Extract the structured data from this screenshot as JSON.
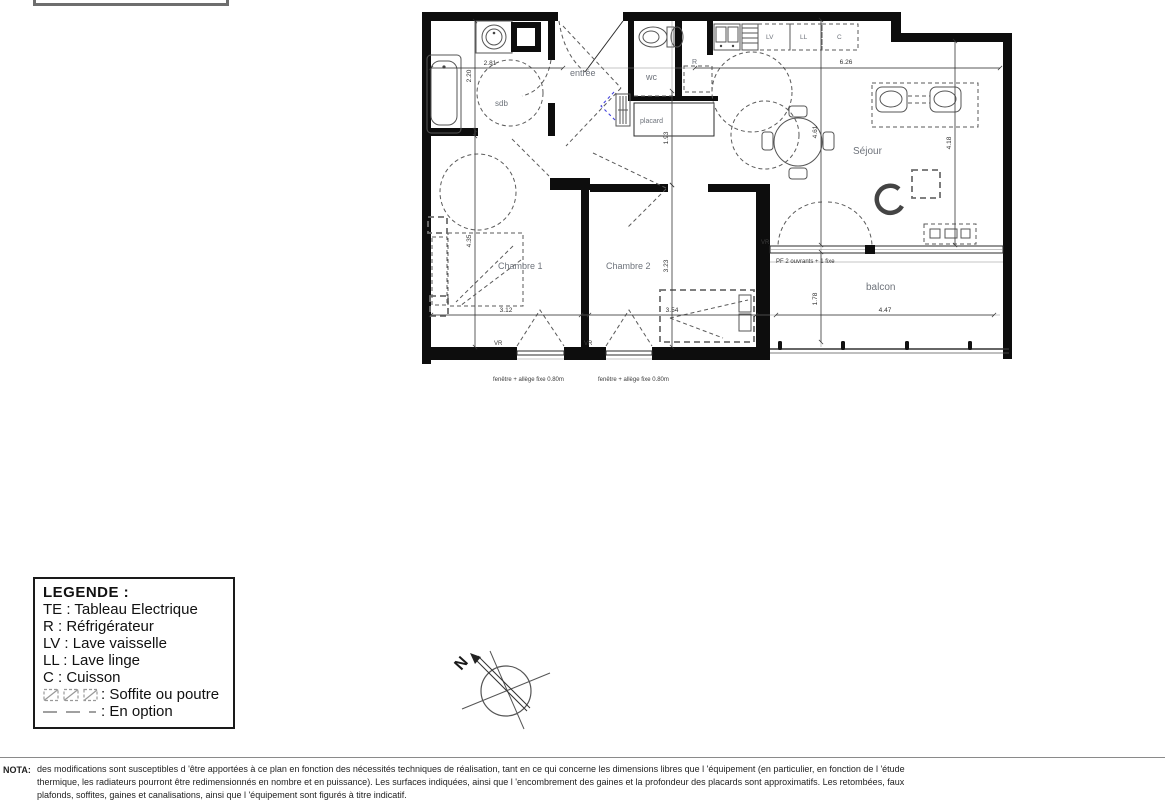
{
  "plan": {
    "room_labels": {
      "sdb": "sdb",
      "entree": "entrée",
      "wc": "wc",
      "placard": "placard",
      "sejour": "Séjour",
      "chambre1": "Chambre 1",
      "chambre2": "Chambre 2",
      "balcon": "balcon"
    },
    "appliance_labels": {
      "lv": "LV",
      "ll": "LL",
      "c": "C",
      "r": "R"
    },
    "annotations": {
      "vr": "VR",
      "pf": "PF 2 ouvrants + 1 fixe",
      "window_note": "fenêtre + allège fixe 0.80m",
      "north": "N"
    },
    "dimensions": {
      "sdb_w": "2.81",
      "sdb_h": "2.20",
      "sejour_w": "6.26",
      "hall_h": "1.93",
      "chambre2_h": "3.23",
      "sejour_h": "4.18",
      "sejour_mid_h": "4.61",
      "chambre1_h": "4.35",
      "chambre1_w": "3.12",
      "chambre2_w": "3.54",
      "balcon_w": "4.47",
      "balcon_h": "1.78"
    }
  },
  "legend": {
    "title": "LEGENDE :",
    "items": [
      "TE : Tableau Electrique",
      "R : Réfrigérateur",
      "LV : Lave vaisselle",
      "LL : Lave linge",
      "C : Cuisson"
    ],
    "soffite_label": ": Soffite ou poutre",
    "option_label": ": En option"
  },
  "nota": {
    "label": "NOTA:",
    "line1": "des modifications sont susceptibles d 'être apportées à ce plan en fonction des nécessités techniques de réalisation, tant en ce qui concerne les dimensions libres que l 'équipement (en particulier, en fonction de l 'étude",
    "line2": "thermique, les radiateurs pourront être redimensionnés en nombre et en puissance). Les surfaces indiquées, ainsi que l 'encombrement des gaines et la profondeur des placards sont approximatifs. Les retombées, faux",
    "line3": "plafonds, soffites, gaines et canalisations, ainsi que l 'équipement sont figurés à titre indicatif."
  }
}
